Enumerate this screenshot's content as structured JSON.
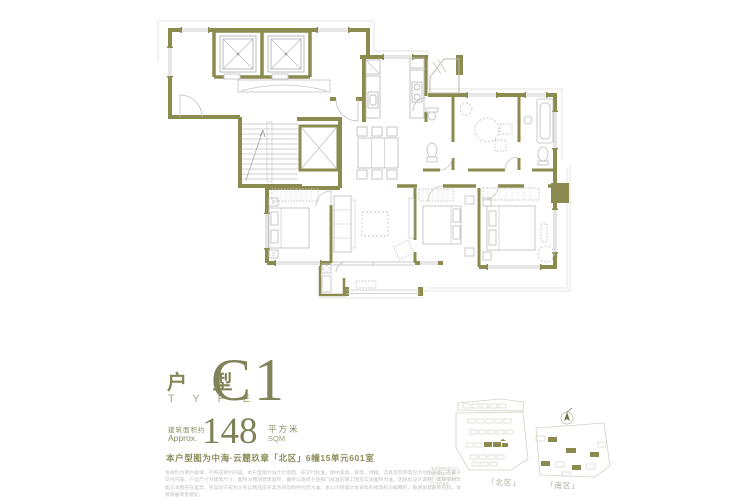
{
  "title_block": {
    "unit_cn": "户 型",
    "unit_en": "T Y P E",
    "unit_code": "C1",
    "area_label_cn": "建筑面积约",
    "area_label_en": "Approx.",
    "area_value": "148",
    "area_unit_cn": "平方米",
    "area_unit_en": "SQM",
    "location_note": "本户型图为中海·云麓玖章「北区」6幢15单元601室"
  },
  "disclaimer": "本资料为要约邀请，不构成要约内容。本户型图为设计示意图，非交付标准，图中家具、家电、绿植、洁具及装饰等仅为功能示意，不属于交付内容。户型尺寸为建筑尺寸，面积为预测建筑面积，最终以政府主管部门核准的施工图及实测面积为准。因规划设计调整，实际交付可能与本图存在差异，买卖双方权利义务以商品房买卖合同及附件约定为准。本公司保留对本资料的修改权与解释权，敬请留意最新资料。详情请垂询售楼处。",
  "site_map": {
    "north_label": "「北区」",
    "south_label": "「南区」",
    "note": "本示意图仅标示户型所在楼栋位置 不代表实际距离方位 仅供参考"
  },
  "colors": {
    "wall": "#8b8b50",
    "accent_text": "#85855a",
    "furniture": "#c6c6c6",
    "light_line": "#dedede"
  },
  "icons": {
    "compass": "north-arrow"
  }
}
